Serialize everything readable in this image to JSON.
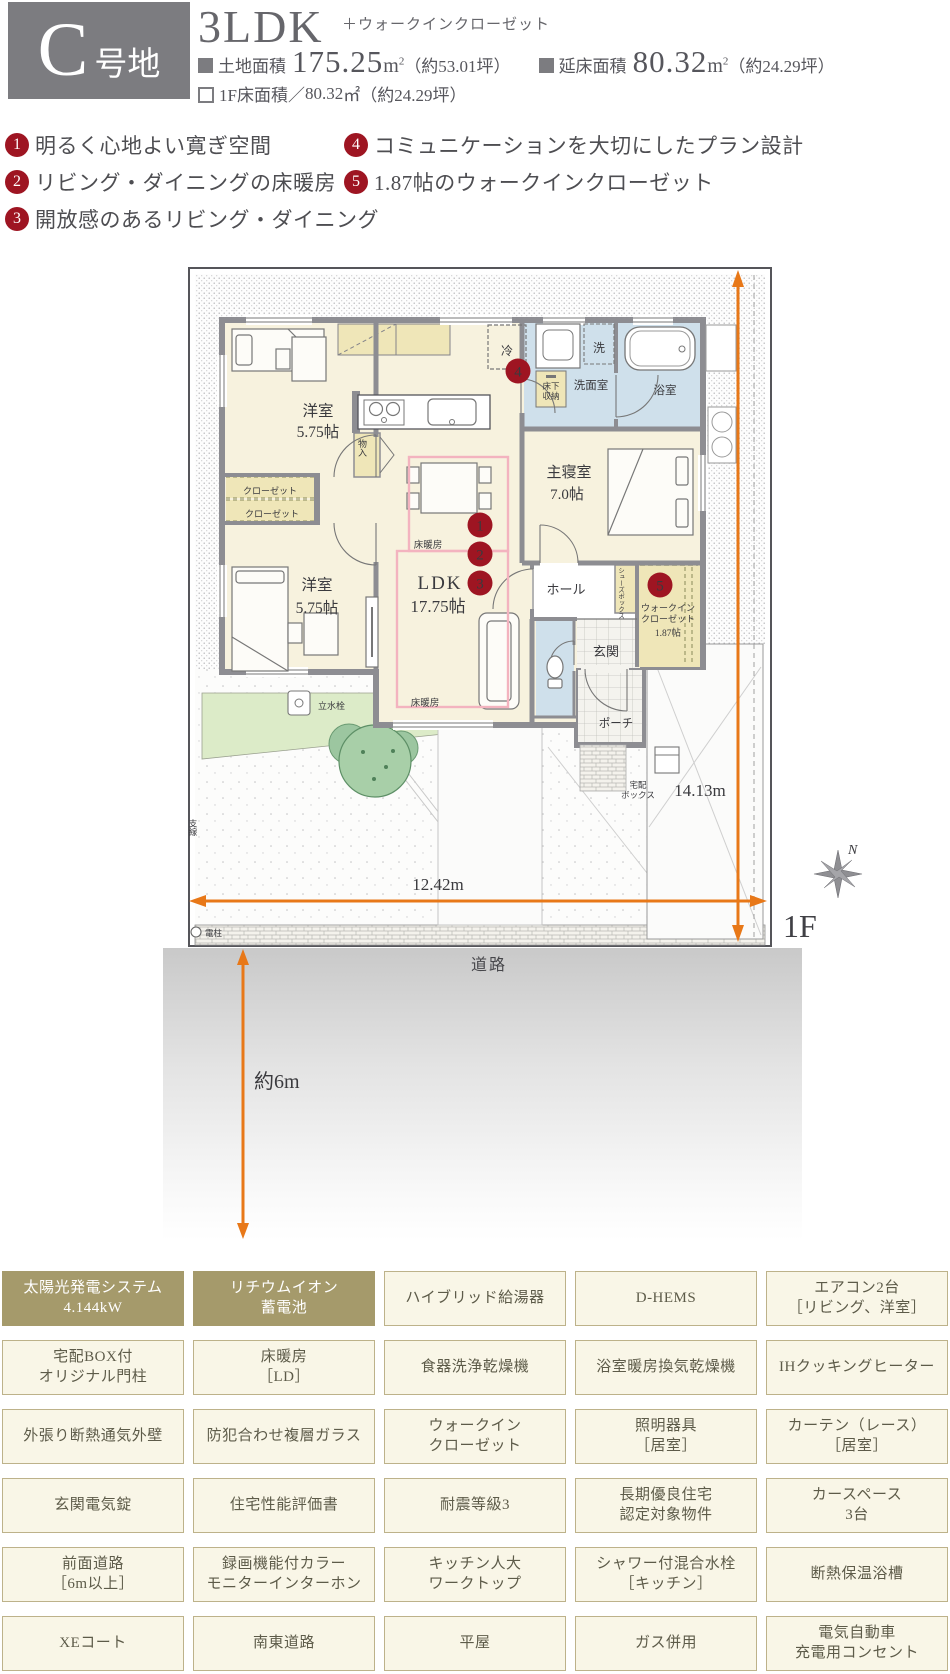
{
  "header": {
    "lot_letter": "C",
    "lot_suffix": "号地",
    "plan_type": "3LDK",
    "plan_note": "＋ウォークインクローゼット",
    "area1_label": "土地面積",
    "area1_value": "175.25",
    "area1_unit": "m",
    "area1_sup": "2",
    "area1_tsubo": "（約53.01坪）",
    "area2_label": "延床面積",
    "area2_value": "80.32",
    "area2_unit": "m",
    "area2_sup": "2",
    "area2_tsubo": "（約24.29坪）",
    "floor_label": "1F床面積",
    "floor_sep": "／",
    "floor_value": "80.32",
    "floor_unit": "㎡",
    "floor_tsubo": "（約24.29坪）"
  },
  "features": [
    {
      "num": "1",
      "text": "明るく心地よい寛ぎ空間"
    },
    {
      "num": "2",
      "text": "リビング・ダイニングの床暖房"
    },
    {
      "num": "3",
      "text": "開放感のあるリビング・ダイニング"
    },
    {
      "num": "4",
      "text": "コミュニケーションを大切にしたプラン設計"
    },
    {
      "num": "5",
      "text": "1.87帖のウォークインクローゼット"
    }
  ],
  "plan": {
    "west1_name": "洋室",
    "west1_size": "5.75帖",
    "west2_name": "洋室",
    "west2_size": "5.75帖",
    "ldk_name": "LDK",
    "ldk_size": "17.75帖",
    "master_name": "主寝室",
    "master_size": "7.0帖",
    "washroom": "洗面室",
    "bath": "浴室",
    "hall": "ホール",
    "entrance": "玄関",
    "porch": "ポーチ",
    "wic_l1": "ウォークイン",
    "wic_l2": "クローゼット",
    "wic_size": "1.87帖",
    "closet1": "クローゼット",
    "closet2": "クローゼット",
    "storage": "物入",
    "fridge": "冷",
    "washer": "洗",
    "underfloor_l1": "床下",
    "underfloor_l2": "収納",
    "floorheat1": "床暖房",
    "floorheat2": "床暖房",
    "shoes_box": "シューズボックス",
    "faucet": "立水栓",
    "delivery_l1": "宅配",
    "delivery_l2": "ボックス",
    "pole": "電柱",
    "wire": "支線",
    "badges": {
      "b1": "1",
      "b2": "2",
      "b3": "3",
      "b4": "4",
      "b5": "5"
    },
    "dim_width": "12.42m",
    "dim_height": "14.13m",
    "setback": "約6m",
    "floor_mark": "1F",
    "road": "道路",
    "compass": "N"
  },
  "equipment": {
    "rows": [
      [
        {
          "lines": [
            "太陽光発電システム",
            "4.144kW"
          ],
          "dark": true
        },
        {
          "lines": [
            "リチウムイオン",
            "蓄電池"
          ],
          "dark": true
        },
        {
          "lines": [
            "ハイブリッド給湯器"
          ],
          "dark": false
        },
        {
          "lines": [
            "D-HEMS"
          ],
          "dark": false
        },
        {
          "lines": [
            "エアコン2台",
            "［リビング、洋室］"
          ],
          "dark": false
        }
      ],
      [
        {
          "lines": [
            "宅配BOX付",
            "オリジナル門柱"
          ],
          "dark": false
        },
        {
          "lines": [
            "床暖房",
            "［LD］"
          ],
          "dark": false
        },
        {
          "lines": [
            "食器洗浄乾燥機"
          ],
          "dark": false
        },
        {
          "lines": [
            "浴室暖房換気乾燥機"
          ],
          "dark": false
        },
        {
          "lines": [
            "IHクッキングヒーター"
          ],
          "dark": false
        }
      ],
      [
        {
          "lines": [
            "外張り断熱通気外壁"
          ],
          "dark": false
        },
        {
          "lines": [
            "防犯合わせ複層ガラス"
          ],
          "dark": false
        },
        {
          "lines": [
            "ウォークイン",
            "クローゼット"
          ],
          "dark": false
        },
        {
          "lines": [
            "照明器具",
            "［居室］"
          ],
          "dark": false
        },
        {
          "lines": [
            "カーテン（レース）",
            "［居室］"
          ],
          "dark": false
        }
      ],
      [
        {
          "lines": [
            "玄関電気錠"
          ],
          "dark": false
        },
        {
          "lines": [
            "住宅性能評価書"
          ],
          "dark": false
        },
        {
          "lines": [
            "耐震等級3"
          ],
          "dark": false
        },
        {
          "lines": [
            "長期優良住宅",
            "認定対象物件"
          ],
          "dark": false
        },
        {
          "lines": [
            "カースペース",
            "3台"
          ],
          "dark": false
        }
      ],
      [
        {
          "lines": [
            "前面道路",
            "［6m以上］"
          ],
          "dark": false
        },
        {
          "lines": [
            "録画機能付カラー",
            "モニターインターホン"
          ],
          "dark": false
        },
        {
          "lines": [
            "キッチン人大",
            "ワークトップ"
          ],
          "dark": false
        },
        {
          "lines": [
            "シャワー付混合水栓",
            "［キッチン］"
          ],
          "dark": false
        },
        {
          "lines": [
            "断熱保温浴槽"
          ],
          "dark": false
        }
      ],
      [
        {
          "lines": [
            "XEコート"
          ],
          "dark": false
        },
        {
          "lines": [
            "南東道路"
          ],
          "dark": false
        },
        {
          "lines": [
            "平屋"
          ],
          "dark": false
        },
        {
          "lines": [
            "ガス併用"
          ],
          "dark": false
        },
        {
          "lines": [
            "電気自動車",
            "充電用コンセント"
          ],
          "dark": false
        }
      ]
    ]
  },
  "colors": {
    "badge_red": "#9e1522",
    "dim_orange": "#e87818",
    "khaki": "#a59a6b",
    "cream_box": "#f9f6e7",
    "box_border": "#bdb28a",
    "lot_gray": "#7c7c80",
    "wall_gray": "#8d8d92",
    "wet_blue": "#cfe0eb",
    "closet_yellow": "#efe6b8",
    "room_cream": "#f7f2de",
    "heat_pink": "#f3b3bf"
  }
}
